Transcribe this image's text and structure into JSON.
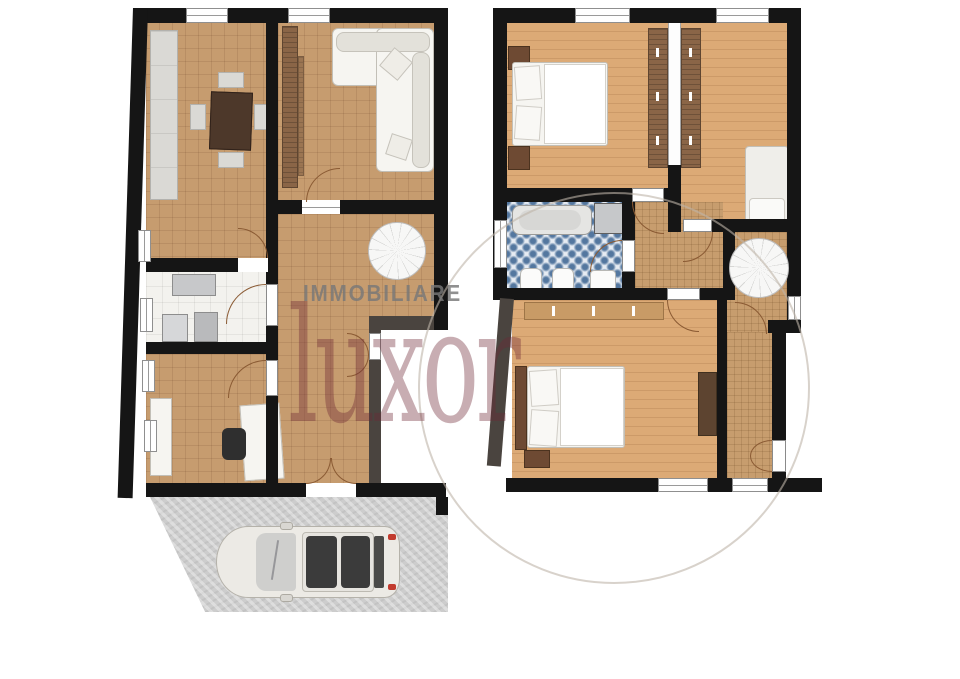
{
  "watermark": {
    "agency_label": "IMMOBILIARE",
    "brand": "luxor",
    "brand_color": "#6e2834",
    "label_color": "#787878"
  },
  "plans": {
    "ground_floor": {
      "rooms": [
        "dining-room",
        "living-room",
        "hallway",
        "kitchen",
        "office"
      ],
      "features": [
        "spiral-staircase",
        "entrance-double-door",
        "sideboard",
        "dining-table",
        "corner-sofa",
        "desk",
        "office-chair"
      ]
    },
    "upper_floor": {
      "rooms": [
        "bedroom-1",
        "bedroom-2",
        "bathroom",
        "landing",
        "bedroom-3",
        "corridor"
      ],
      "features": [
        "spiral-staircase",
        "bathtub",
        "shower",
        "double-bed",
        "single-bed",
        "wardrobes",
        "dresser"
      ]
    },
    "exterior": {
      "features": [
        "driveway",
        "parked-car"
      ]
    }
  },
  "palette": {
    "wall": "#151515",
    "wall_gray": "#4a443f",
    "tile_floor": "#c69c6f",
    "wood_floor": "#dcaa76",
    "bath_tile_blue": "#54779f",
    "kitchen_floor": "#f3f2ee",
    "concrete": "#cdcdcd",
    "car_body": "#eceae5"
  }
}
